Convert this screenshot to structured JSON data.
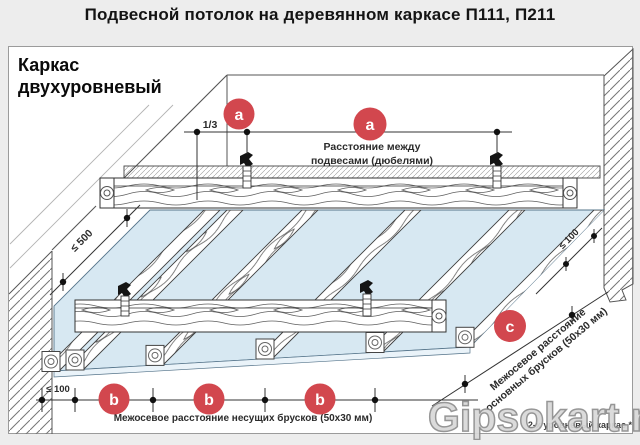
{
  "title": "Подвесной потолок на деревянном каркасе П111, П211",
  "panel": {
    "heading_line1": "Каркас",
    "heading_line2": "двухуровневый",
    "footnote": "2-х уровневый каркас *"
  },
  "markers": {
    "a": "a",
    "b": "b",
    "c": "c"
  },
  "dimensions": {
    "fraction": "1/3",
    "left_max": "≤ 500",
    "right_max": "≤ 100",
    "bottom_left_max": "≤ 100"
  },
  "labels": {
    "hangers_line1": "Расстояние между",
    "hangers_line2": "подвесами (дюбелями)",
    "carrier_spacing": "Межосевое расстояние несущих брусков (50x30 мм)",
    "main_spacing_line1": "Межосевое расстояние",
    "main_spacing_line2": "основных брусков (50x30 мм)"
  },
  "watermark": "Gipsokart.ru",
  "colors": {
    "accent_red": "#d2474e",
    "board_blue": "#d7e8f2",
    "panel_border": "#9b9b9b"
  }
}
